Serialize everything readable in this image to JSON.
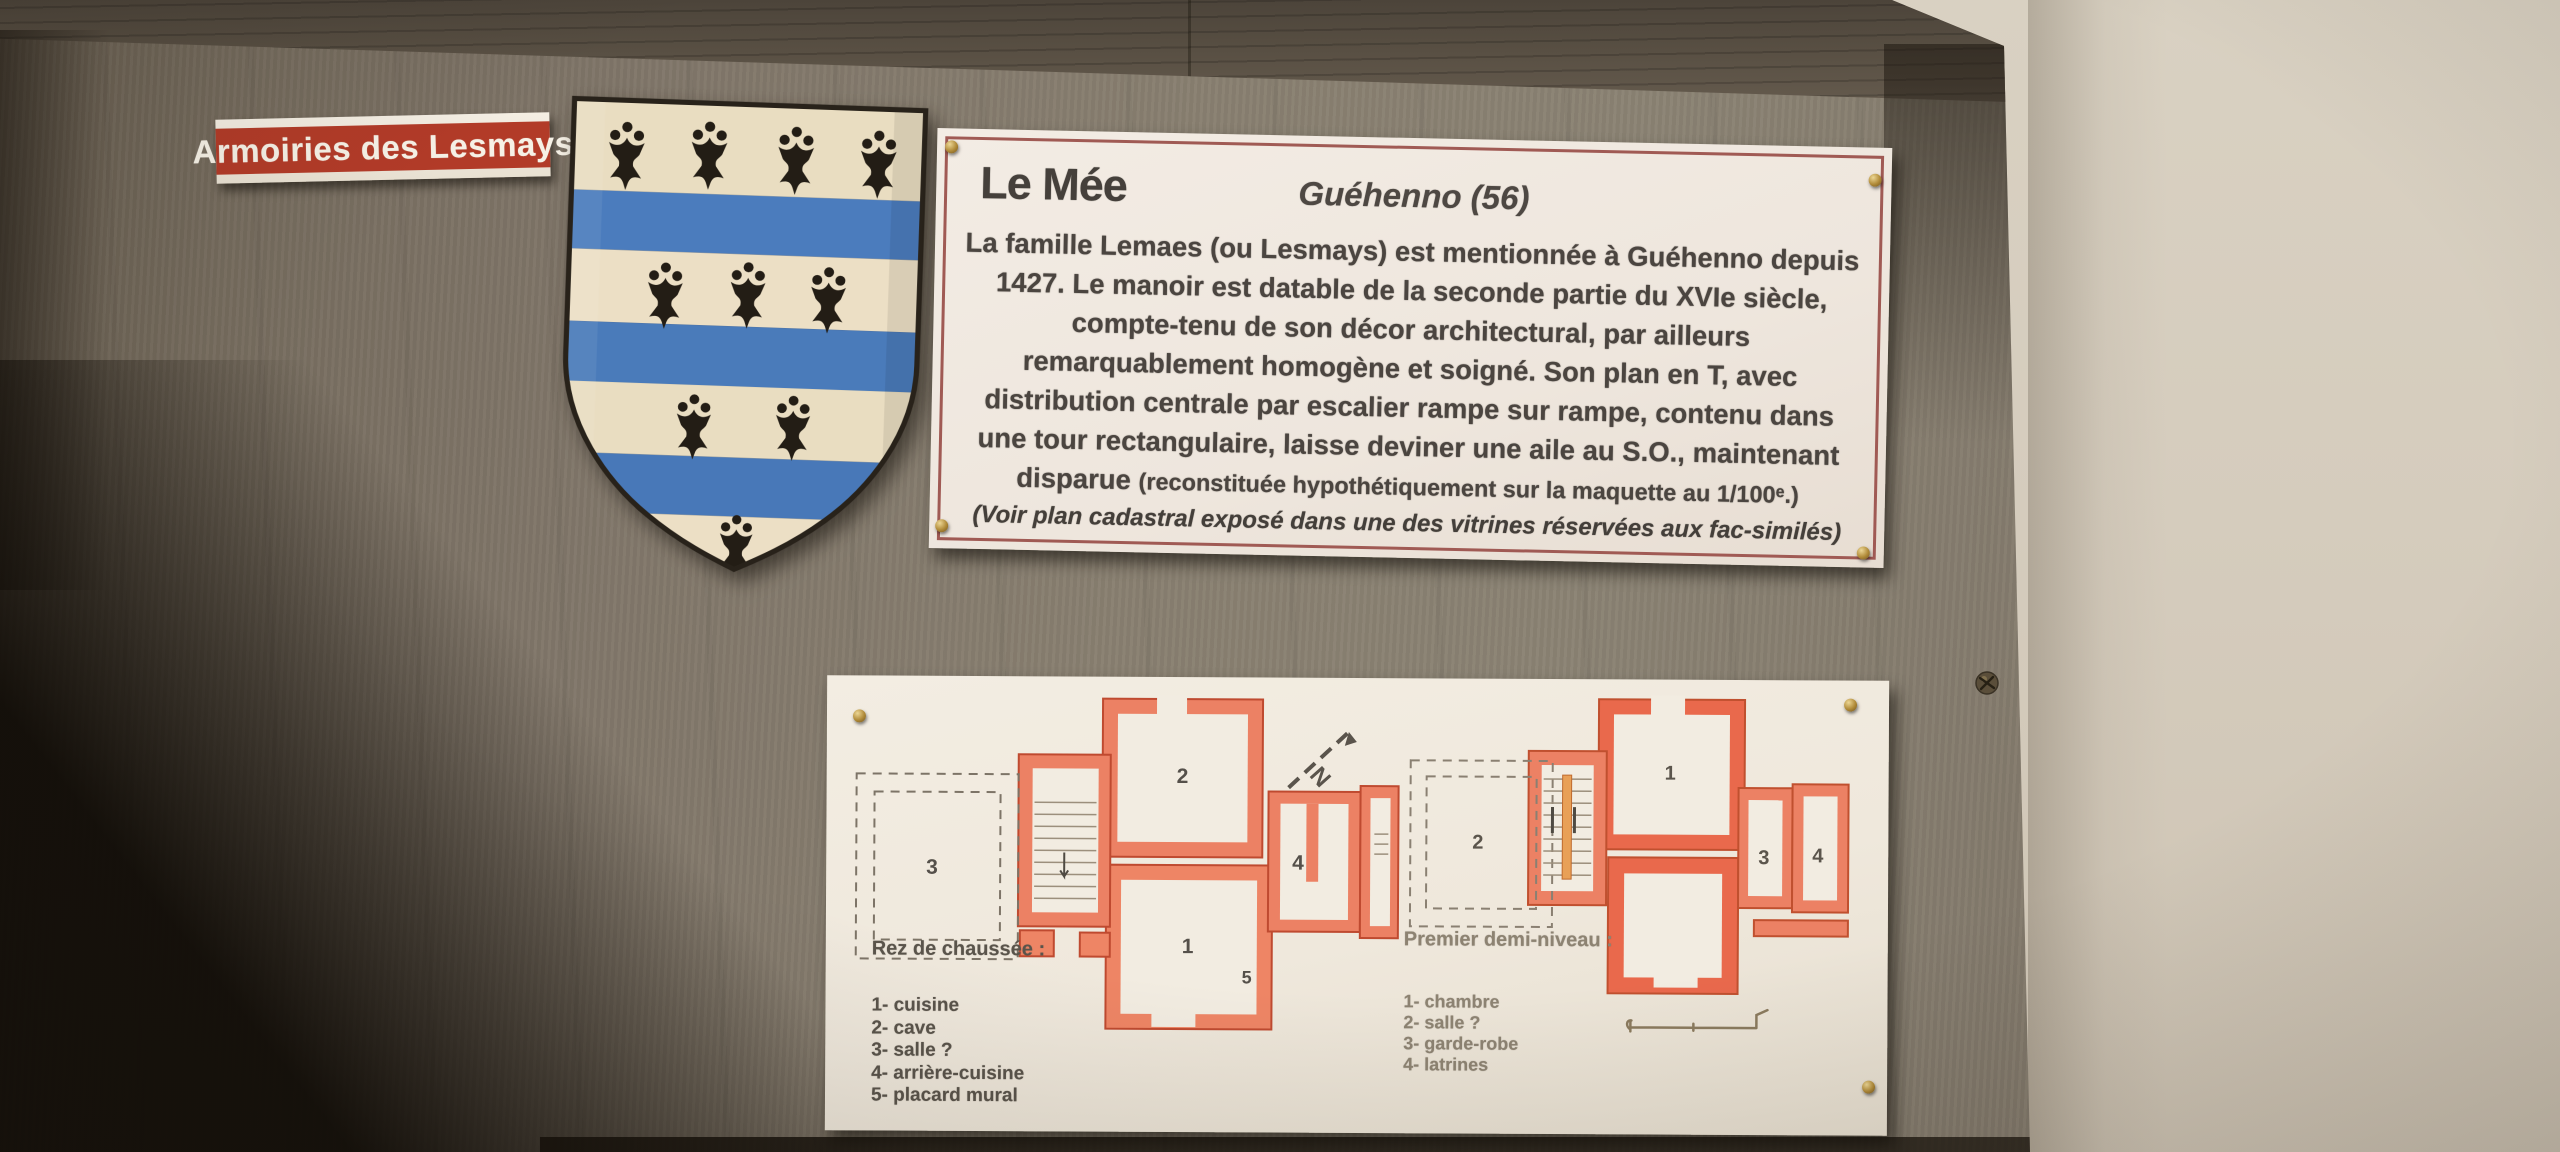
{
  "label_plate": {
    "text": "Armoiries des Lesmays"
  },
  "plaque": {
    "title": "Le Mée",
    "subtitle": "Guéhenno (56)",
    "lines": [
      "La famille Lemaes (ou Lesmays) est mentionnée à Guéhenno depuis",
      "1427. Le manoir est datable de la seconde partie du XVIe siècle,",
      "compte-tenu de son décor architectural, par ailleurs",
      "remarquablement homogène et soigné. Son plan en T, avec",
      "distribution centrale par escalier rampe sur rampe, contenu dans",
      "une tour rectangulaire, laisse deviner une aile au S.O., maintenant"
    ],
    "line_disparue": "disparue",
    "line_paren": "(reconstituée hypothétiquement sur la maquette au 1/100ᵉ.)",
    "footnote": "(Voir plan cadastral exposé dans une des vitrines réservées aux fac-similés)"
  },
  "floorplans": {
    "ground": {
      "heading": "Rez de chaussée :",
      "legend": [
        "1- cuisine",
        "2- cave",
        "3- salle ?",
        "4- arrière-cuisine",
        "5- placard mural"
      ],
      "rooms": {
        "r1": "1",
        "r2": "2",
        "r3": "3",
        "r4": "4",
        "r5": "5"
      },
      "north_label": "N"
    },
    "first": {
      "heading": "Premier demi-niveau :",
      "legend": [
        "1- chambre",
        "2- salle ?",
        "3- garde-robe",
        "4- latrines"
      ],
      "rooms": {
        "r1": "1",
        "r2": "2",
        "r3": "3",
        "r4": "4"
      }
    }
  },
  "colors": {
    "label_red": "#b23b28",
    "shield_blue": "#4b7cbd",
    "shield_cream": "#e9ddc1",
    "ermine_black": "#231d15",
    "plan_wall_orange": "#ec8164",
    "plaque_border_red": "#a05a54",
    "board_grey_brown": "#898071",
    "wall_beige": "#d5ccbd"
  }
}
